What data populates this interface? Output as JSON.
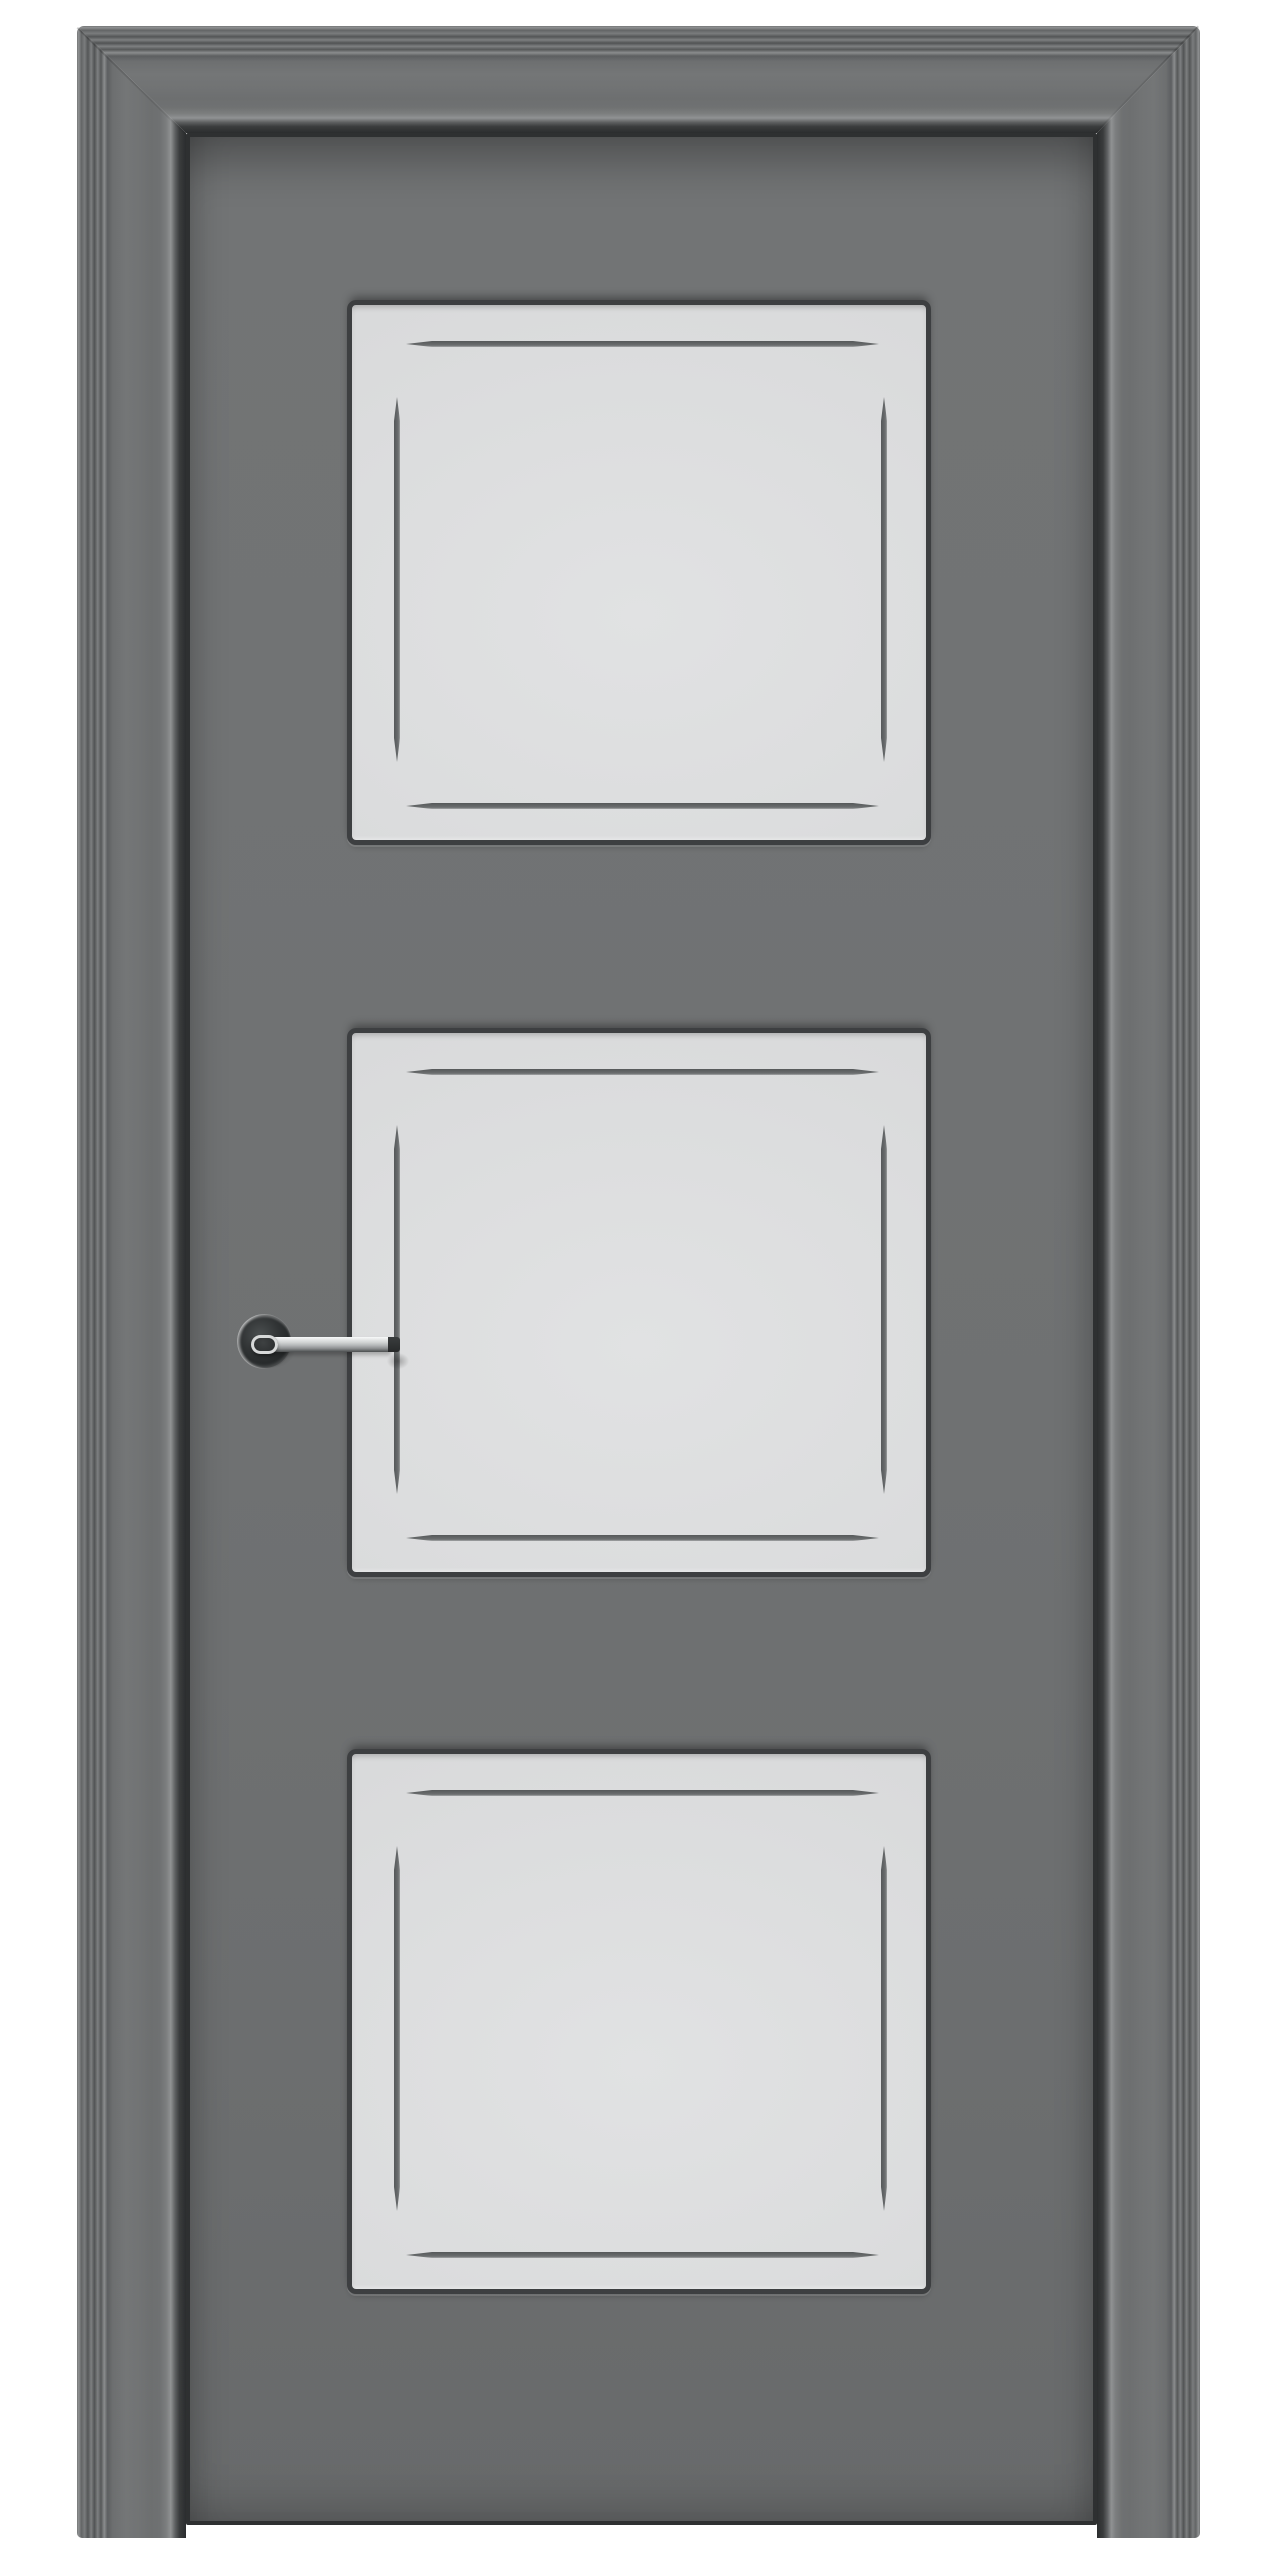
{
  "scene": {
    "subject": "three-panel interior door product render",
    "background_color": "#ffffff"
  },
  "door": {
    "casing": {
      "name": "fluted-door-casing",
      "color_base": "#737576",
      "color_flute_highlight": "#8f9192",
      "color_flute_shadow": "#515354",
      "color_inner_lip": "#909293",
      "color_reveal_gap": "#2b2d2e"
    },
    "leaf": {
      "name": "door-leaf",
      "color": "#6e7071",
      "color_edge_shadow": "#4a4c4d",
      "edge_outline": "#2e3031"
    },
    "panel_style": {
      "face_color": "#dadbdc",
      "face_color_bright": "#e1e2e3",
      "recess_border_color": "#3d3f41",
      "groove_color": "#616465",
      "groove_highlight": "#b6b8b9",
      "grooves_per_panel": 4
    },
    "panels": [
      {
        "name": "top panel"
      },
      {
        "name": "middle panel"
      },
      {
        "name": "bottom panel"
      }
    ],
    "handle": {
      "name": "lever handle",
      "finish": "polished chrome",
      "rosette_color": "#2a2d2e",
      "rosette_rim_highlight": "#e8eaea",
      "lever_highlight": "#f8f9f9",
      "lever_shadow": "#4c4f50",
      "tip_color": "#27292a",
      "mounted_side": "left stile",
      "pointing": "right"
    }
  }
}
